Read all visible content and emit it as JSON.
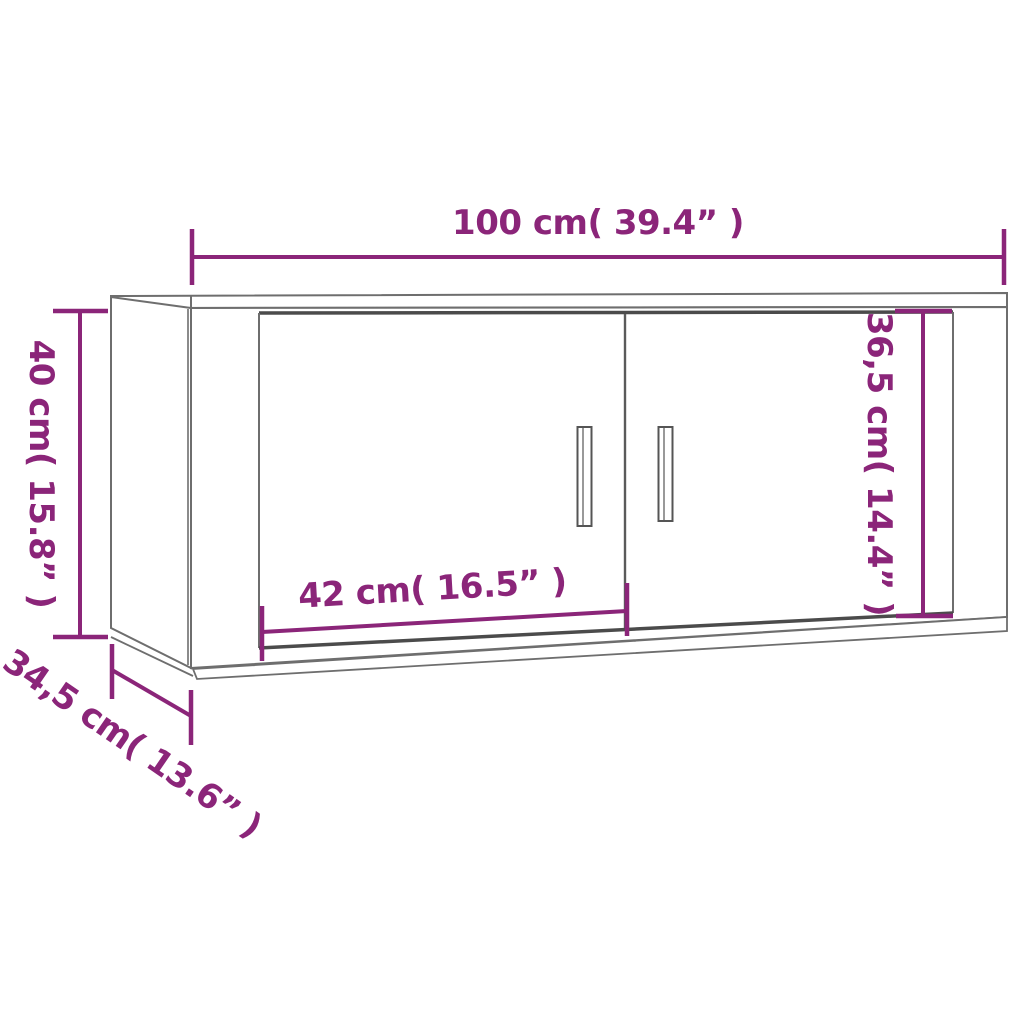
{
  "diagram": {
    "title": "Wall-mounted cabinet dimension drawing",
    "object": "wall cabinet with two doors and vertical handles",
    "colors": {
      "dimension_accent": "#8b2579",
      "outline_gray": "#6e6e6e",
      "shadow_gray": "#4b4b4b",
      "background": "#ffffff"
    },
    "dimensions": {
      "overall_width": {
        "label": "100 cm( 39.4” )",
        "cm": "100",
        "inch": "39.4"
      },
      "overall_height": {
        "label": "40 cm( 15.8” )",
        "cm": "40",
        "inch": "15.8"
      },
      "door_width": {
        "label": "42 cm( 16.5” )",
        "cm": "42",
        "inch": "16.5"
      },
      "door_height": {
        "label": "36,5 cm( 14.4” )",
        "cm": "36,5",
        "inch": "14.4"
      },
      "depth": {
        "label": "34,5 cm( 13.6” )",
        "cm": "34,5",
        "inch": "13.6"
      }
    }
  }
}
